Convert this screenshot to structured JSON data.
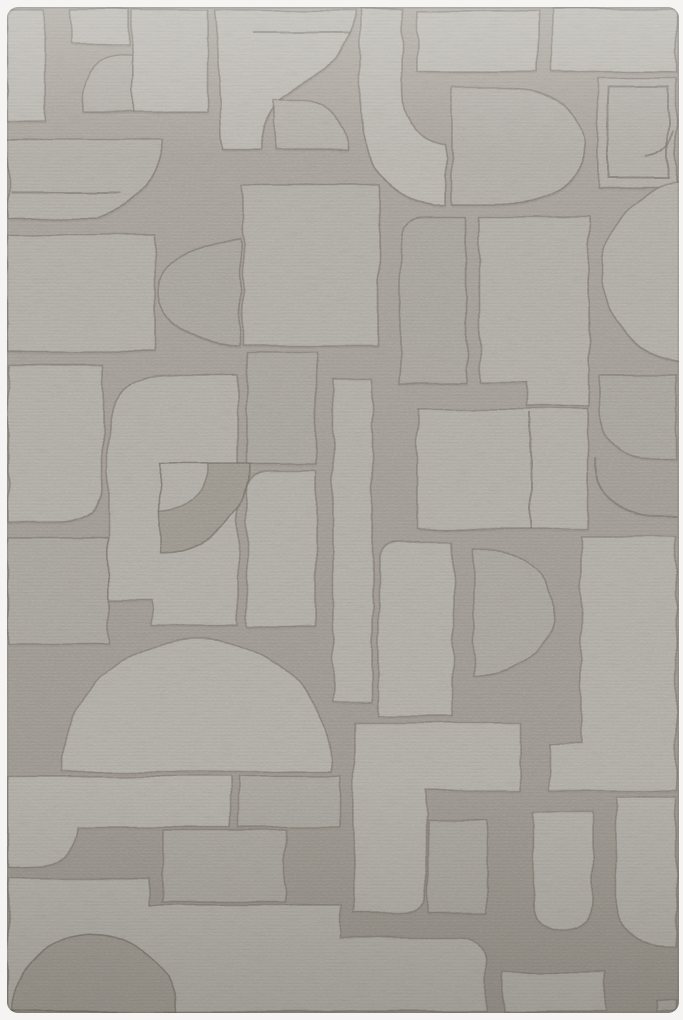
{
  "scene": {
    "type": "product-photograph",
    "subject": "rug",
    "description": "Overhead product photograph of a rectangular light gray hand-carved rug with a tonal abstract geometric pattern of arches, domes, quarter-circles, bands and blocks, shown on a white background.",
    "orientation": "portrait",
    "pattern_style": "abstract geometric, carved high-low pile, tone-on-tone gray"
  },
  "palette": {
    "surround": "#f5f4f2",
    "field_top": "#aba69f",
    "field": "#a39e97",
    "field_bottom": "#99948c",
    "field_dark": "#9e9991",
    "tile_light": "#bab7b1",
    "tile_mid": "#b2aea8",
    "tile_deep": "#a9a59f",
    "groove": "#78726a",
    "shadow": "#4f4a43"
  },
  "rug": {
    "bounds": {
      "x": 7,
      "y": 7,
      "width": 672,
      "height": 1006,
      "corner_radius": 11
    },
    "shapes": [
      {
        "name": "tile-corner-block",
        "kind": "tile",
        "fill": "tile_light",
        "d": "M7,10 H45 V122 H7 Z"
      },
      {
        "name": "tile-top-strip",
        "kind": "tile",
        "fill": "tile_light",
        "d": "M72,10 H130 V43 H72 Z"
      },
      {
        "name": "tile-tombstone",
        "kind": "tile",
        "fill": "tile_mid",
        "d": "M120,55 H133 V112 H82 V108 Q83,57 120,55 Z"
      },
      {
        "name": "tile-top-bar",
        "kind": "tile",
        "fill": "tile_light",
        "d": "M133,10 H207 V112 H133 Z"
      },
      {
        "name": "tile-arch",
        "kind": "tile",
        "fill": "tile_light",
        "d": "M214,10 H355 Q349,60 300,85 Q263,103 259,150 H222 Q219,58 214,10 Z"
      },
      {
        "name": "tile-quarter-bud",
        "kind": "tile",
        "fill": "tile_mid",
        "d": "M274,99 H302 A46,51 0 0 1 348,150 H274 Z"
      },
      {
        "name": "tile-j-band",
        "kind": "tile",
        "fill": "tile_light",
        "d": "M360,8 H402 V90 Q402,136 446,144 L446,205 H436 Q360,194 360,98 Z"
      },
      {
        "name": "tile-top-square",
        "kind": "tile",
        "fill": "tile_light",
        "d": "M417,10 H538 V72 H417 Z"
      },
      {
        "name": "tile-top-right-band",
        "kind": "tile",
        "fill": "tile_light",
        "d": "M552,8 H676 V72 H552 Z"
      },
      {
        "name": "tile-frame",
        "kind": "tile",
        "fill": "tile_mid",
        "d": "M598,79 H676 V188 H598 Z"
      },
      {
        "name": "tile-fan",
        "kind": "tile",
        "fill": "tile_mid",
        "d": "M452,88 H512 A73,58 0 0 1 512,204 H452 Z"
      },
      {
        "name": "tile-right-disc",
        "kind": "tile",
        "fill": "tile_mid",
        "d": "M603,272 A92,92 0 1 1 787,272 A92,92 0 1 1 603,272 Z"
      },
      {
        "name": "tile-mid-block",
        "kind": "tile",
        "fill": "tile_mid",
        "d": "M480,218 H589 V407 H527 V383 H480 Z"
      },
      {
        "name": "tile-small-rounded",
        "kind": "tile",
        "fill": "tile_deep",
        "d": "M425,217 H467 V383 H400 V242 Q400,217 425,217 Z"
      },
      {
        "name": "tile-center-rect",
        "kind": "tile",
        "fill": "tile_mid",
        "d": "M417,410 H588 V529 H417 Z"
      },
      {
        "name": "tile-right-mid",
        "kind": "tile",
        "fill": "tile_deep",
        "d": "M600,375 H676 V458 H648 A48,48 0 0 1 600,410 Z"
      },
      {
        "name": "tile-left-band",
        "kind": "tile",
        "fill": "tile_mid",
        "d": "M8,140 H163 Q156,196 100,217 L8,218 Z"
      },
      {
        "name": "tile-left-rect",
        "kind": "tile",
        "fill": "tile_mid",
        "d": "M7,235 H155 V352 H7 Z"
      },
      {
        "name": "tile-half-disc-left",
        "kind": "tile",
        "fill": "tile_deep",
        "d": "M240,238 A82,54 0 0 0 240,346 Z"
      },
      {
        "name": "tile-mid-left-upper",
        "kind": "tile",
        "fill": "tile_mid",
        "d": "M243,185 H378 V345 H243 Z"
      },
      {
        "name": "tile-rounded-left",
        "kind": "tile",
        "fill": "tile_mid",
        "d": "M8,365 H103 V476 Q103,522 57,522 L8,522 Z"
      },
      {
        "name": "tile-small-left",
        "kind": "tile",
        "fill": "tile_deep",
        "d": "M8,538 H108 V645 H8 Z"
      },
      {
        "name": "tile-arch-mass",
        "kind": "tile",
        "fill": "tile_mid",
        "d": "M108,443 Q108,375 168,375 L238,375 V625 H152 V600 H108 Z"
      },
      {
        "name": "recess-quarter-pie",
        "kind": "recess",
        "fill": "field_dark",
        "d": "M160,463 H250 A90,90 0 0 1 160,553 Z"
      },
      {
        "name": "tile-quarter-pie-inner",
        "kind": "tile",
        "fill": "tile_mid",
        "d": "M160,463 H208 A48,48 0 0 1 160,511 Z"
      },
      {
        "name": "tile-mid-left2",
        "kind": "tile",
        "fill": "tile_deep",
        "d": "M247,352 H316 V463 H247 Z"
      },
      {
        "name": "tile-mid-left3",
        "kind": "tile",
        "fill": "tile_mid",
        "d": "M269,470 H316 V628 H247 V492 Q247,470 269,470 Z"
      },
      {
        "name": "tile-tall-bar",
        "kind": "tile",
        "fill": "tile_mid",
        "d": "M333,378 H372 V702 H333 Z"
      },
      {
        "name": "tile-big-dome",
        "kind": "tile",
        "fill": "tile_mid",
        "d": "M62,772 A135,134 0 0 1 332,772 Z"
      },
      {
        "name": "tile-boot",
        "kind": "tile",
        "fill": "tile_mid",
        "d": "M8,777 H230 V827 H78 Q76,862 40,866 L8,867 Z"
      },
      {
        "name": "tile-boot2",
        "kind": "tile",
        "fill": "tile_deep",
        "d": "M238,777 H341 V827 H238 Z"
      },
      {
        "name": "tile-mid-small",
        "kind": "tile",
        "fill": "tile_deep",
        "d": "M163,830 H285 V902 H163 Z"
      },
      {
        "name": "tile-bottom-band",
        "kind": "tile",
        "fill": "tile_mid",
        "d": "M8,878 H150 V905 H341 V938 H460 A26,26 0 0 1 486,964 L486,1012 H8 Z"
      },
      {
        "name": "recess-bottom-dome",
        "kind": "recess",
        "fill": "field_dark",
        "d": "M12,1012 A82,78 0 0 1 176,1012 Z"
      },
      {
        "name": "tile-tall",
        "kind": "tile",
        "fill": "tile_mid",
        "d": "M402,541 H454 V716 H378 V565 Q378,541 402,541 Z"
      },
      {
        "name": "tile-half-disc",
        "kind": "tile",
        "fill": "tile_deep",
        "d": "M474,546 A80,65 0 0 1 474,676 Z"
      },
      {
        "name": "tile-bottom-right-big",
        "kind": "tile",
        "fill": "tile_mid",
        "d": "M581,537 H676 V790 H550 V743 H581 Z"
      },
      {
        "name": "tile-L",
        "kind": "tile",
        "fill": "tile_mid",
        "d": "M354,723 H520 V790 H426 V890 Q426,913 400,913 L354,913 Z"
      },
      {
        "name": "tile-small-mid",
        "kind": "tile",
        "fill": "tile_deep",
        "d": "M428,820 H487 V913 H428 Z"
      },
      {
        "name": "tile-u-inner",
        "kind": "tile",
        "fill": "tile_mid",
        "d": "M533,812 H593 V898 Q593,931 561,931 Q533,931 533,898 Z"
      },
      {
        "name": "tile-right-of-u",
        "kind": "tile",
        "fill": "tile_mid",
        "d": "M617,797 H676 V948 H667 A50,50 0 0 1 617,898 Z"
      },
      {
        "name": "tile-below-u",
        "kind": "tile",
        "fill": "tile_mid",
        "d": "M503,972 H605 V1012 H503 Z"
      },
      {
        "name": "tile-corner-br",
        "kind": "tile",
        "fill": "tile_deep",
        "d": "M657,1000 H676 V1012 H657 Z"
      },
      {
        "name": "groove-frame-inner",
        "kind": "line",
        "d": "M608,88 H668 V178 H608 Z"
      },
      {
        "name": "groove-frame-notch",
        "kind": "line",
        "d": "M673,131 Q669,153 648,157"
      },
      {
        "name": "groove-arch-line",
        "kind": "line",
        "d": "M253,32 H350"
      },
      {
        "name": "groove-band-line",
        "kind": "line",
        "d": "M10,193 H120"
      },
      {
        "name": "groove-ribbon-arc",
        "kind": "line",
        "d": "M596,458 Q598,512 652,516 L676,516"
      },
      {
        "name": "groove-center-split",
        "kind": "line",
        "d": "M530,413 V529"
      }
    ]
  }
}
